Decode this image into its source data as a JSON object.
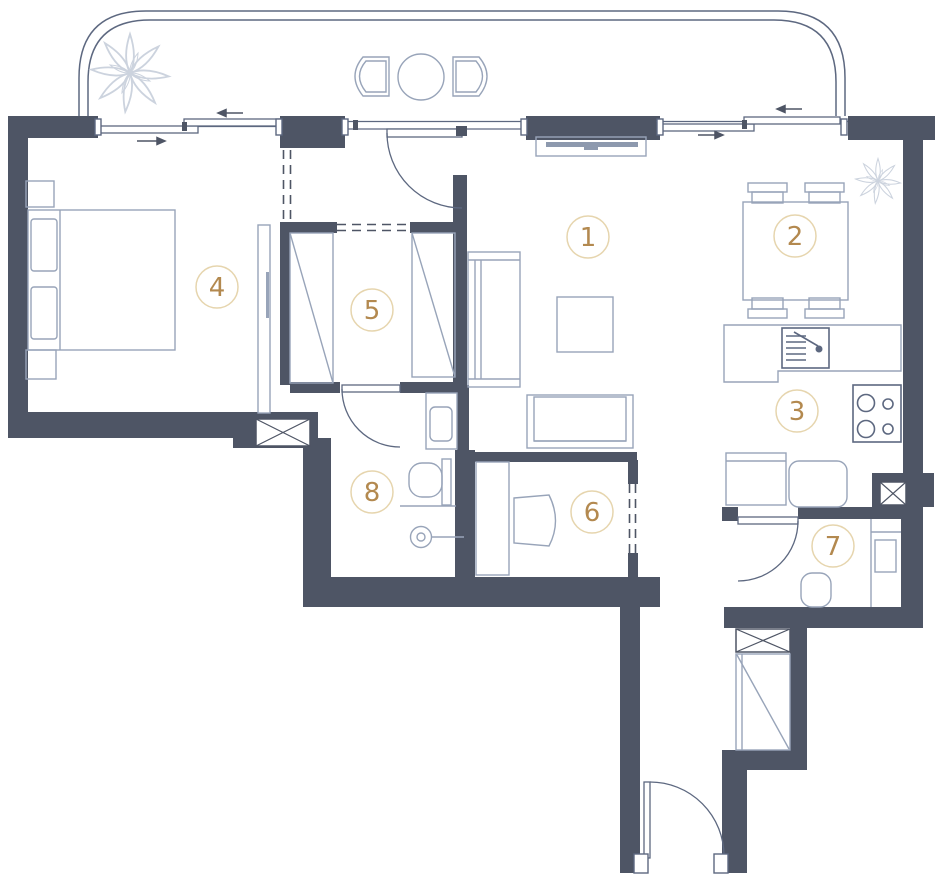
{
  "plan": {
    "type": "apartment-floor-plan",
    "colors": {
      "wall": "#4e5565",
      "furn": "#98a4b9",
      "fixture": "#5d6880",
      "ring": "#e6d5ae",
      "num": "#b3894f",
      "plant": "#ccd3de"
    },
    "rooms": [
      {
        "name": "living-room",
        "number": "1"
      },
      {
        "name": "dining-area",
        "number": "2"
      },
      {
        "name": "kitchen",
        "number": "3"
      },
      {
        "name": "bedroom",
        "number": "4"
      },
      {
        "name": "wardrobe",
        "number": "5"
      },
      {
        "name": "study",
        "number": "6"
      },
      {
        "name": "toilet",
        "number": "7"
      },
      {
        "name": "bathroom",
        "number": "8"
      }
    ]
  }
}
